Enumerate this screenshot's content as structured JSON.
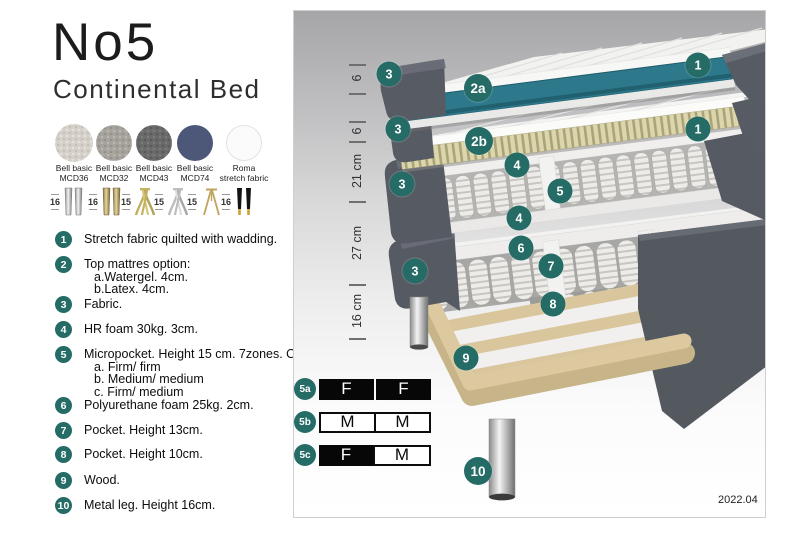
{
  "header": {
    "title": "No5",
    "subtitle": "Continental Bed"
  },
  "swatches": [
    {
      "line1": "Bell basic",
      "line2": "MCD36"
    },
    {
      "line1": "Bell basic",
      "line2": "MCD32"
    },
    {
      "line1": "Bell basic",
      "line2": "MCD43"
    },
    {
      "line1": "Bell basic",
      "line2": "MCD74"
    },
    {
      "line1": "Roma",
      "line2": "stretch fabric"
    }
  ],
  "leg_options": [
    {
      "height": "16",
      "style": "cylinder-silver"
    },
    {
      "height": "16",
      "style": "cylinder-brass"
    },
    {
      "height": "15",
      "style": "splayed-gold"
    },
    {
      "height": "15",
      "style": "splayed-silver"
    },
    {
      "height": "15",
      "style": "hairpin-gold"
    },
    {
      "height": "16",
      "style": "tapered-black-gold"
    }
  ],
  "features": [
    {
      "num": "1",
      "text": "Stretch fabric quilted with wadding."
    },
    {
      "num": "2",
      "text": "Top mattres option:",
      "sub": [
        "a.Watergel. 4cm.",
        "b.Latex. 4cm."
      ]
    },
    {
      "num": "3",
      "text": "Fabric."
    },
    {
      "num": "4",
      "text": "HR foam 30kg. 3cm."
    },
    {
      "num": "5",
      "text": "Micropocket. Height 15 cm. 7zones. Option:",
      "sub": [
        "a. Firm/ firm",
        "b. Medium/ medium",
        "c. Firm/ medium"
      ]
    },
    {
      "num": "6",
      "text": "Polyurethane foam 25kg. 2cm."
    },
    {
      "num": "7",
      "text": "Pocket. Height 13cm."
    },
    {
      "num": "8",
      "text": "Pocket. Height 10cm."
    },
    {
      "num": "9",
      "text": "Wood."
    },
    {
      "num": "10",
      "text": "Metal leg. Height 16cm."
    }
  ],
  "diagram": {
    "ruler": [
      {
        "label": "6"
      },
      {
        "label": "6"
      },
      {
        "label": "21 cm"
      },
      {
        "label": "27 cm"
      },
      {
        "label": "16 cm"
      }
    ],
    "callouts": [
      {
        "label": "1"
      },
      {
        "label": "3"
      },
      {
        "label": "2a"
      },
      {
        "label": "1"
      },
      {
        "label": "3"
      },
      {
        "label": "2b"
      },
      {
        "label": "4"
      },
      {
        "label": "5"
      },
      {
        "label": "3"
      },
      {
        "label": "4"
      },
      {
        "label": "6"
      },
      {
        "label": "7"
      },
      {
        "label": "3"
      },
      {
        "label": "8"
      },
      {
        "label": "9"
      },
      {
        "label": "10"
      }
    ],
    "firmness": [
      {
        "id": "5a",
        "cells": [
          {
            "letter": "F",
            "dark": true
          },
          {
            "letter": "F",
            "dark": true
          }
        ]
      },
      {
        "id": "5b",
        "cells": [
          {
            "letter": "M",
            "dark": false
          },
          {
            "letter": "M",
            "dark": false
          }
        ]
      },
      {
        "id": "5c",
        "cells": [
          {
            "letter": "F",
            "dark": true
          },
          {
            "letter": "M",
            "dark": false
          }
        ]
      }
    ],
    "version": "2022.04"
  },
  "colors": {
    "accent_teal": "#266c66",
    "watergel_teal": "#2d788a",
    "fabric_gray": "#585c64",
    "latex": "#ddd6ac",
    "wood": "#d9c79e"
  }
}
